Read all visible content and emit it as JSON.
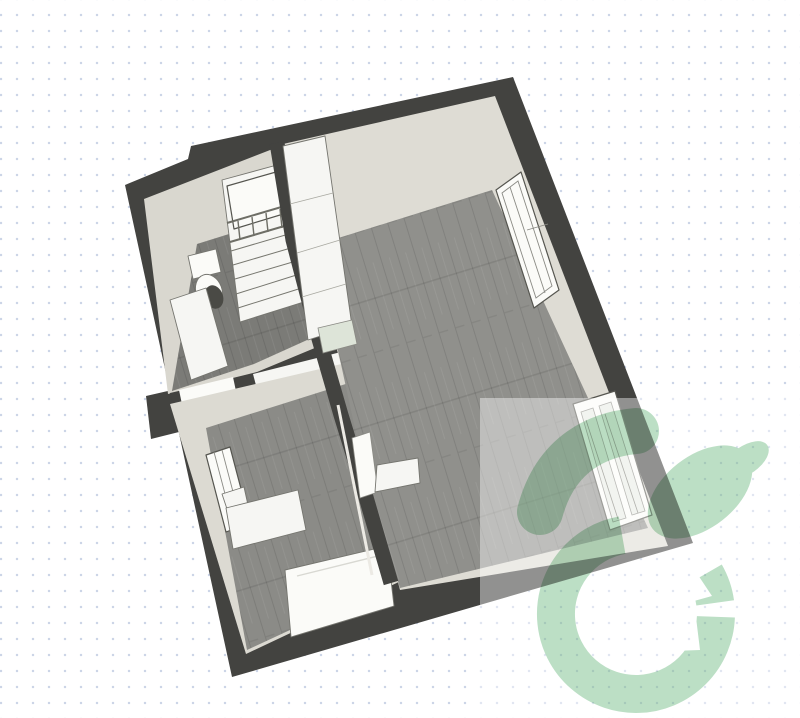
{
  "canvas": {
    "background_color": "#ffffff",
    "dot_color": "#ccd5e7",
    "dot_spacing_px": 16
  },
  "colors": {
    "wall": "#434340",
    "wall_face_bath": "#d9d7cf",
    "wall_face_bed": "#dcdad2",
    "wall_face_main": "#dedcd4",
    "floor_bath": "#7b7b77",
    "floor_bed": "#8b8b87",
    "floor_main": "#90908c",
    "furniture_white": "#f6f6f3",
    "white_trim": "#fbfbf8",
    "panel_glass": "#e9ece5",
    "counter_end": "#dde4d8",
    "toilet_shadow": "#4a4a45",
    "overlay_white": "rgba(255,255,255,0.42)",
    "watermark_green": "#bcdfc5"
  },
  "scene": {
    "view": "3d-top-down-floor-plan",
    "rooms": [
      {
        "id": "bathroom-stairwell",
        "floor": "dark-wood",
        "contents": [
          "staircase",
          "toilet",
          "vanity-counter"
        ]
      },
      {
        "id": "bedroom",
        "floor": "grey-wood",
        "contents": [
          "window",
          "desk",
          "bed"
        ]
      },
      {
        "id": "living-kitchen",
        "floor": "grey-wood",
        "contents": [
          "kitchen-unit",
          "window",
          "french-door",
          "open-door"
        ]
      }
    ],
    "watermark": "house-in-circle-logo",
    "overlay": "white-highlight-rectangle-bottom-right"
  }
}
